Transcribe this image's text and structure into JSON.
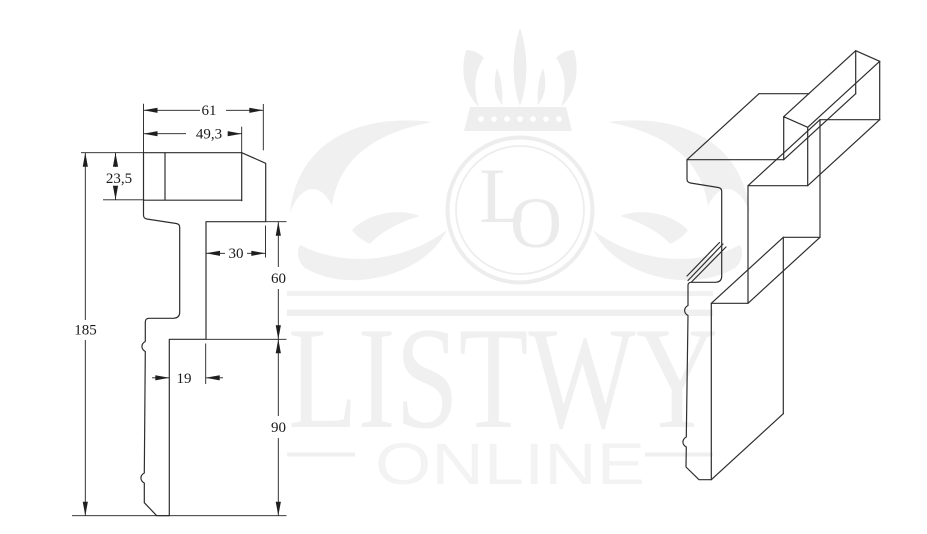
{
  "meta": {
    "title": "Molding profile technical drawing",
    "canvas_width": 927,
    "canvas_height": 534
  },
  "watermark": {
    "brand": "LISTWY",
    "tagline": "ONLINE",
    "monogram_l": "L",
    "monogram_o": "O"
  },
  "dimensions": {
    "total_width": "61",
    "cap_width": "49,3",
    "cap_height": "23,5",
    "total_height": "185",
    "nose_depth": "30",
    "nose_height": "60",
    "web_thickness": "19",
    "lower_height": "90"
  },
  "colors": {
    "background": "#ffffff",
    "drawing_line": "#2e2e2e",
    "dimension_line": "#1f1f1f",
    "watermark_gray": "#f0f0f0"
  }
}
